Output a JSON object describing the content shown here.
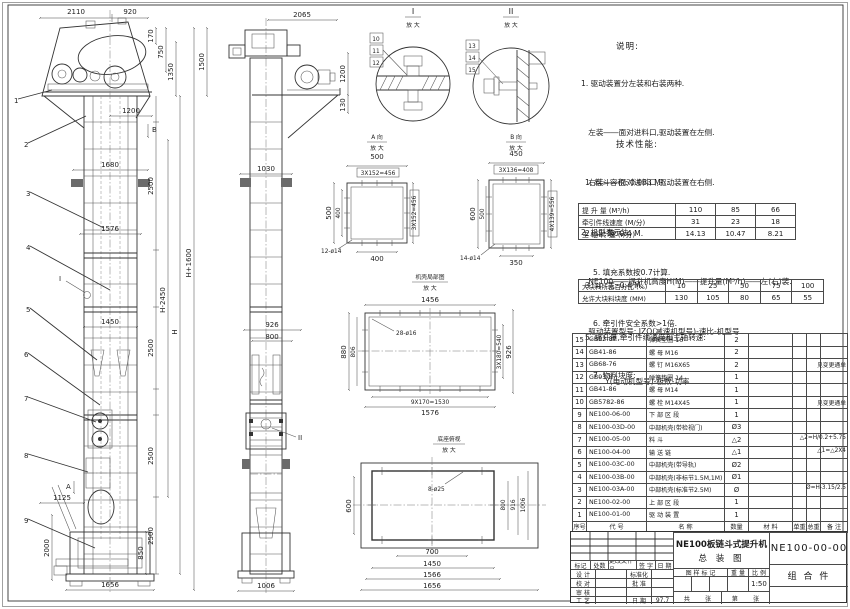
{
  "dims": {
    "d2110": "2110",
    "d920": "920",
    "d170": "170",
    "d750": "750",
    "d1350": "1350",
    "d1500": "1500",
    "d1200": "1200",
    "d1680": "1680",
    "d1576": "1576",
    "d2500": "2500",
    "d1450": "1450",
    "dH2450": "H-2450",
    "dH": "H",
    "dH1600": "H+1600",
    "d1125": "1125",
    "d2000": "2000",
    "d850": "850",
    "d1656": "1656",
    "d2065": "2065",
    "d130": "130",
    "d1030": "1030",
    "d926": "926",
    "d800": "800",
    "d1006": "1006"
  },
  "markers": {
    "a": "A",
    "b": "B",
    "i": "I",
    "ii": "II"
  },
  "callouts": {
    "c1": "1",
    "c2": "2",
    "c3": "3",
    "c4": "4",
    "c5": "5",
    "c6": "6",
    "c7": "7",
    "c8": "8",
    "c9": "9",
    "c10": "10",
    "c11": "11",
    "c12": "12",
    "c13": "13",
    "c14": "14",
    "c15": "15"
  },
  "details": {
    "i": {
      "t": "I",
      "sub": "放 大"
    },
    "ii": {
      "t": "II",
      "sub": "放 大"
    }
  },
  "view_a": {
    "title": "A 向",
    "sub": "放 大",
    "top": "500",
    "top2": "3X152=456",
    "left": "500",
    "left2": "400",
    "bottom": "400",
    "right": "3X152=456",
    "holes": "12-ø14"
  },
  "view_b": {
    "title": "B 向",
    "sub": "放 大",
    "top": "450",
    "top2": "3X136=408",
    "left": "600",
    "left2": "500",
    "bottom": "350",
    "right": "4X139=556",
    "holes": "14-ø14"
  },
  "view_casing": {
    "title": "机壳局部图",
    "sub": "放 大",
    "top": "1456",
    "left": "880",
    "left2": "806",
    "holes": "28-ø16",
    "right": "3X180=540",
    "right2": "926",
    "bottom": "9X170=1530",
    "bottom2": "1576"
  },
  "view_base": {
    "title": "底座俯视",
    "sub": "放 大",
    "holes": "8-ø25",
    "left": "600",
    "right1": "800",
    "right2": "916",
    "right3": "1006",
    "b1": "700",
    "b2": "1450",
    "b3": "1566",
    "b4": "1656"
  },
  "notes": {
    "heading": "说明:",
    "lines": [
      "1. 驱动装置分左装和右装两种.",
      "   左装――面对进料口,驱动装置在左侧.",
      "   右装――面对进料口,驱动装置在右侧.",
      "2. 机型表示法:",
      "   NE100――提升机高度H(M)――提升量(M³/h)――左(右)装.",
      "   驱动装置型号: JZQ(减速机型号)-速比-机型号",
      "          Y(电动机型号)-极数-功率"
    ]
  },
  "tech": {
    "heading": "技术性能:",
    "items_top": [
      "1. 料斗容积: 0.033 M³.",
      "2. 斗  距: 0.4 M.",
      "3. 斗  宽: 0.4 M.",
      "5. 提升量,牵引件线速度和主轴转速:"
    ],
    "table1": {
      "rows": [
        {
          "label": "提 升 量  (M³/h)",
          "values": [
            "110",
            "85",
            "66"
          ]
        },
        {
          "label": "牵引件线速度 (M/分)",
          "values": [
            "31",
            "23",
            "18"
          ]
        },
        {
          "label": "主 轴 转 速  (r/分)",
          "values": [
            "14.13",
            "10.47",
            "8.21"
          ]
        }
      ]
    },
    "items_mid": [
      "5. 填充系数按0.7计算.",
      "6. 牵引件安全系数>1倍.",
      "7. 物料块度:"
    ],
    "table2": {
      "rows": [
        {
          "label": "大块料所占百分比 (%)",
          "values": [
            "10",
            "25",
            "50",
            "75",
            "100"
          ]
        },
        {
          "label": "允许大块料块度 (MM)",
          "values": [
            "130",
            "105",
            "80",
            "65",
            "55"
          ]
        }
      ]
    }
  },
  "bom": {
    "headers": {
      "no": "序号",
      "code": "代  号",
      "name": "名    称",
      "qty": "数量",
      "mat": "材  料",
      "uw": "单重",
      "tw": "总重",
      "rmk": "备  注"
    },
    "rows": [
      {
        "no": "15",
        "code": "GB93-87",
        "name": "弹簧垫圈  16",
        "qty": "2",
        "mat": "",
        "uw": "",
        "tw": "",
        "remark": ""
      },
      {
        "no": "14",
        "code": "GB41-86",
        "name": "螺  母  M16",
        "qty": "2",
        "mat": "",
        "uw": "",
        "tw": "",
        "remark": ""
      },
      {
        "no": "13",
        "code": "GB68-76",
        "name": "螺  钉  M16X65",
        "qty": "2",
        "mat": "",
        "uw": "",
        "tw": "",
        "remark": "见变更通单"
      },
      {
        "no": "12",
        "code": "GB93-87",
        "name": "弹簧垫圈  14",
        "qty": "1",
        "mat": "",
        "uw": "",
        "tw": "",
        "remark": ""
      },
      {
        "no": "11",
        "code": "GB41-86",
        "name": "螺  母  M14",
        "qty": "1",
        "mat": "",
        "uw": "",
        "tw": "",
        "remark": ""
      },
      {
        "no": "10",
        "code": "GB5782-86",
        "name": "螺  栓  M14X45",
        "qty": "1",
        "mat": "",
        "uw": "",
        "tw": "",
        "remark": "见变更通单"
      },
      {
        "no": "9",
        "code": "NE100-06-00",
        "name": "下 部 区 段",
        "qty": "1",
        "mat": "",
        "uw": "",
        "tw": "",
        "remark": ""
      },
      {
        "no": "8",
        "code": "NE100-03D-00",
        "name": "中部机壳(带检视门)",
        "qty": "Ø3",
        "mat": "",
        "uw": "",
        "tw": "",
        "remark": ""
      },
      {
        "no": "7",
        "code": "NE100-05-00",
        "name": "料  斗",
        "qty": "△2",
        "mat": "",
        "uw": "",
        "tw": "",
        "remark": "△2=H/0.2+5.75"
      },
      {
        "no": "6",
        "code": "NE100-04-00",
        "name": "输 送 链",
        "qty": "△1",
        "mat": "",
        "uw": "",
        "tw": "",
        "remark": "△1=△2X4"
      },
      {
        "no": "5",
        "code": "NE100-03C-00",
        "name": "中部机壳(带导轨)",
        "qty": "Ø2",
        "mat": "",
        "uw": "",
        "tw": "",
        "remark": ""
      },
      {
        "no": "4",
        "code": "NE100-03B-00",
        "name": "中部机壳(非标节1.5M,1M)",
        "qty": "Ø1",
        "mat": "",
        "uw": "",
        "tw": "",
        "remark": ""
      },
      {
        "no": "3",
        "code": "NE100-03A-00",
        "name": "中部机壳(标准节2.5M)",
        "qty": "Ø",
        "mat": "",
        "uw": "",
        "tw": "",
        "remark": "Ø=H-3.15/2.5"
      },
      {
        "no": "2",
        "code": "NE100-02-00",
        "name": "上 部 区 段",
        "qty": "1",
        "mat": "",
        "uw": "",
        "tw": "",
        "remark": ""
      },
      {
        "no": "1",
        "code": "NE100-01-00",
        "name": "驱 动 装 置",
        "qty": "1",
        "mat": "",
        "uw": "",
        "tw": "",
        "remark": ""
      }
    ]
  },
  "title_block": {
    "product": "NE100板链斗式提升机",
    "drawing_name": "总  装  图",
    "drawing_no": "NE100-00-00",
    "part_type": "组  合  件",
    "rev_header": {
      "mark": "标记",
      "count": "处数",
      "doc": "更改文件号",
      "sign": "签 字",
      "date": "日 期"
    },
    "sig_rows": [
      {
        "a": "设 计",
        "b": "标准化",
        "c": ""
      },
      {
        "a": "校 对",
        "b": "批 准",
        "c": ""
      },
      {
        "a": "审 核",
        "b": "",
        "c": ""
      },
      {
        "a": "工 艺",
        "b": "日 期",
        "c": "97.7"
      }
    ],
    "stamp_label": "图 样 标 记",
    "weight_label": "重 量",
    "scale_label": "比 例",
    "scale": "1:50",
    "sheet_total": "共        张",
    "sheet_no": "第        张"
  }
}
